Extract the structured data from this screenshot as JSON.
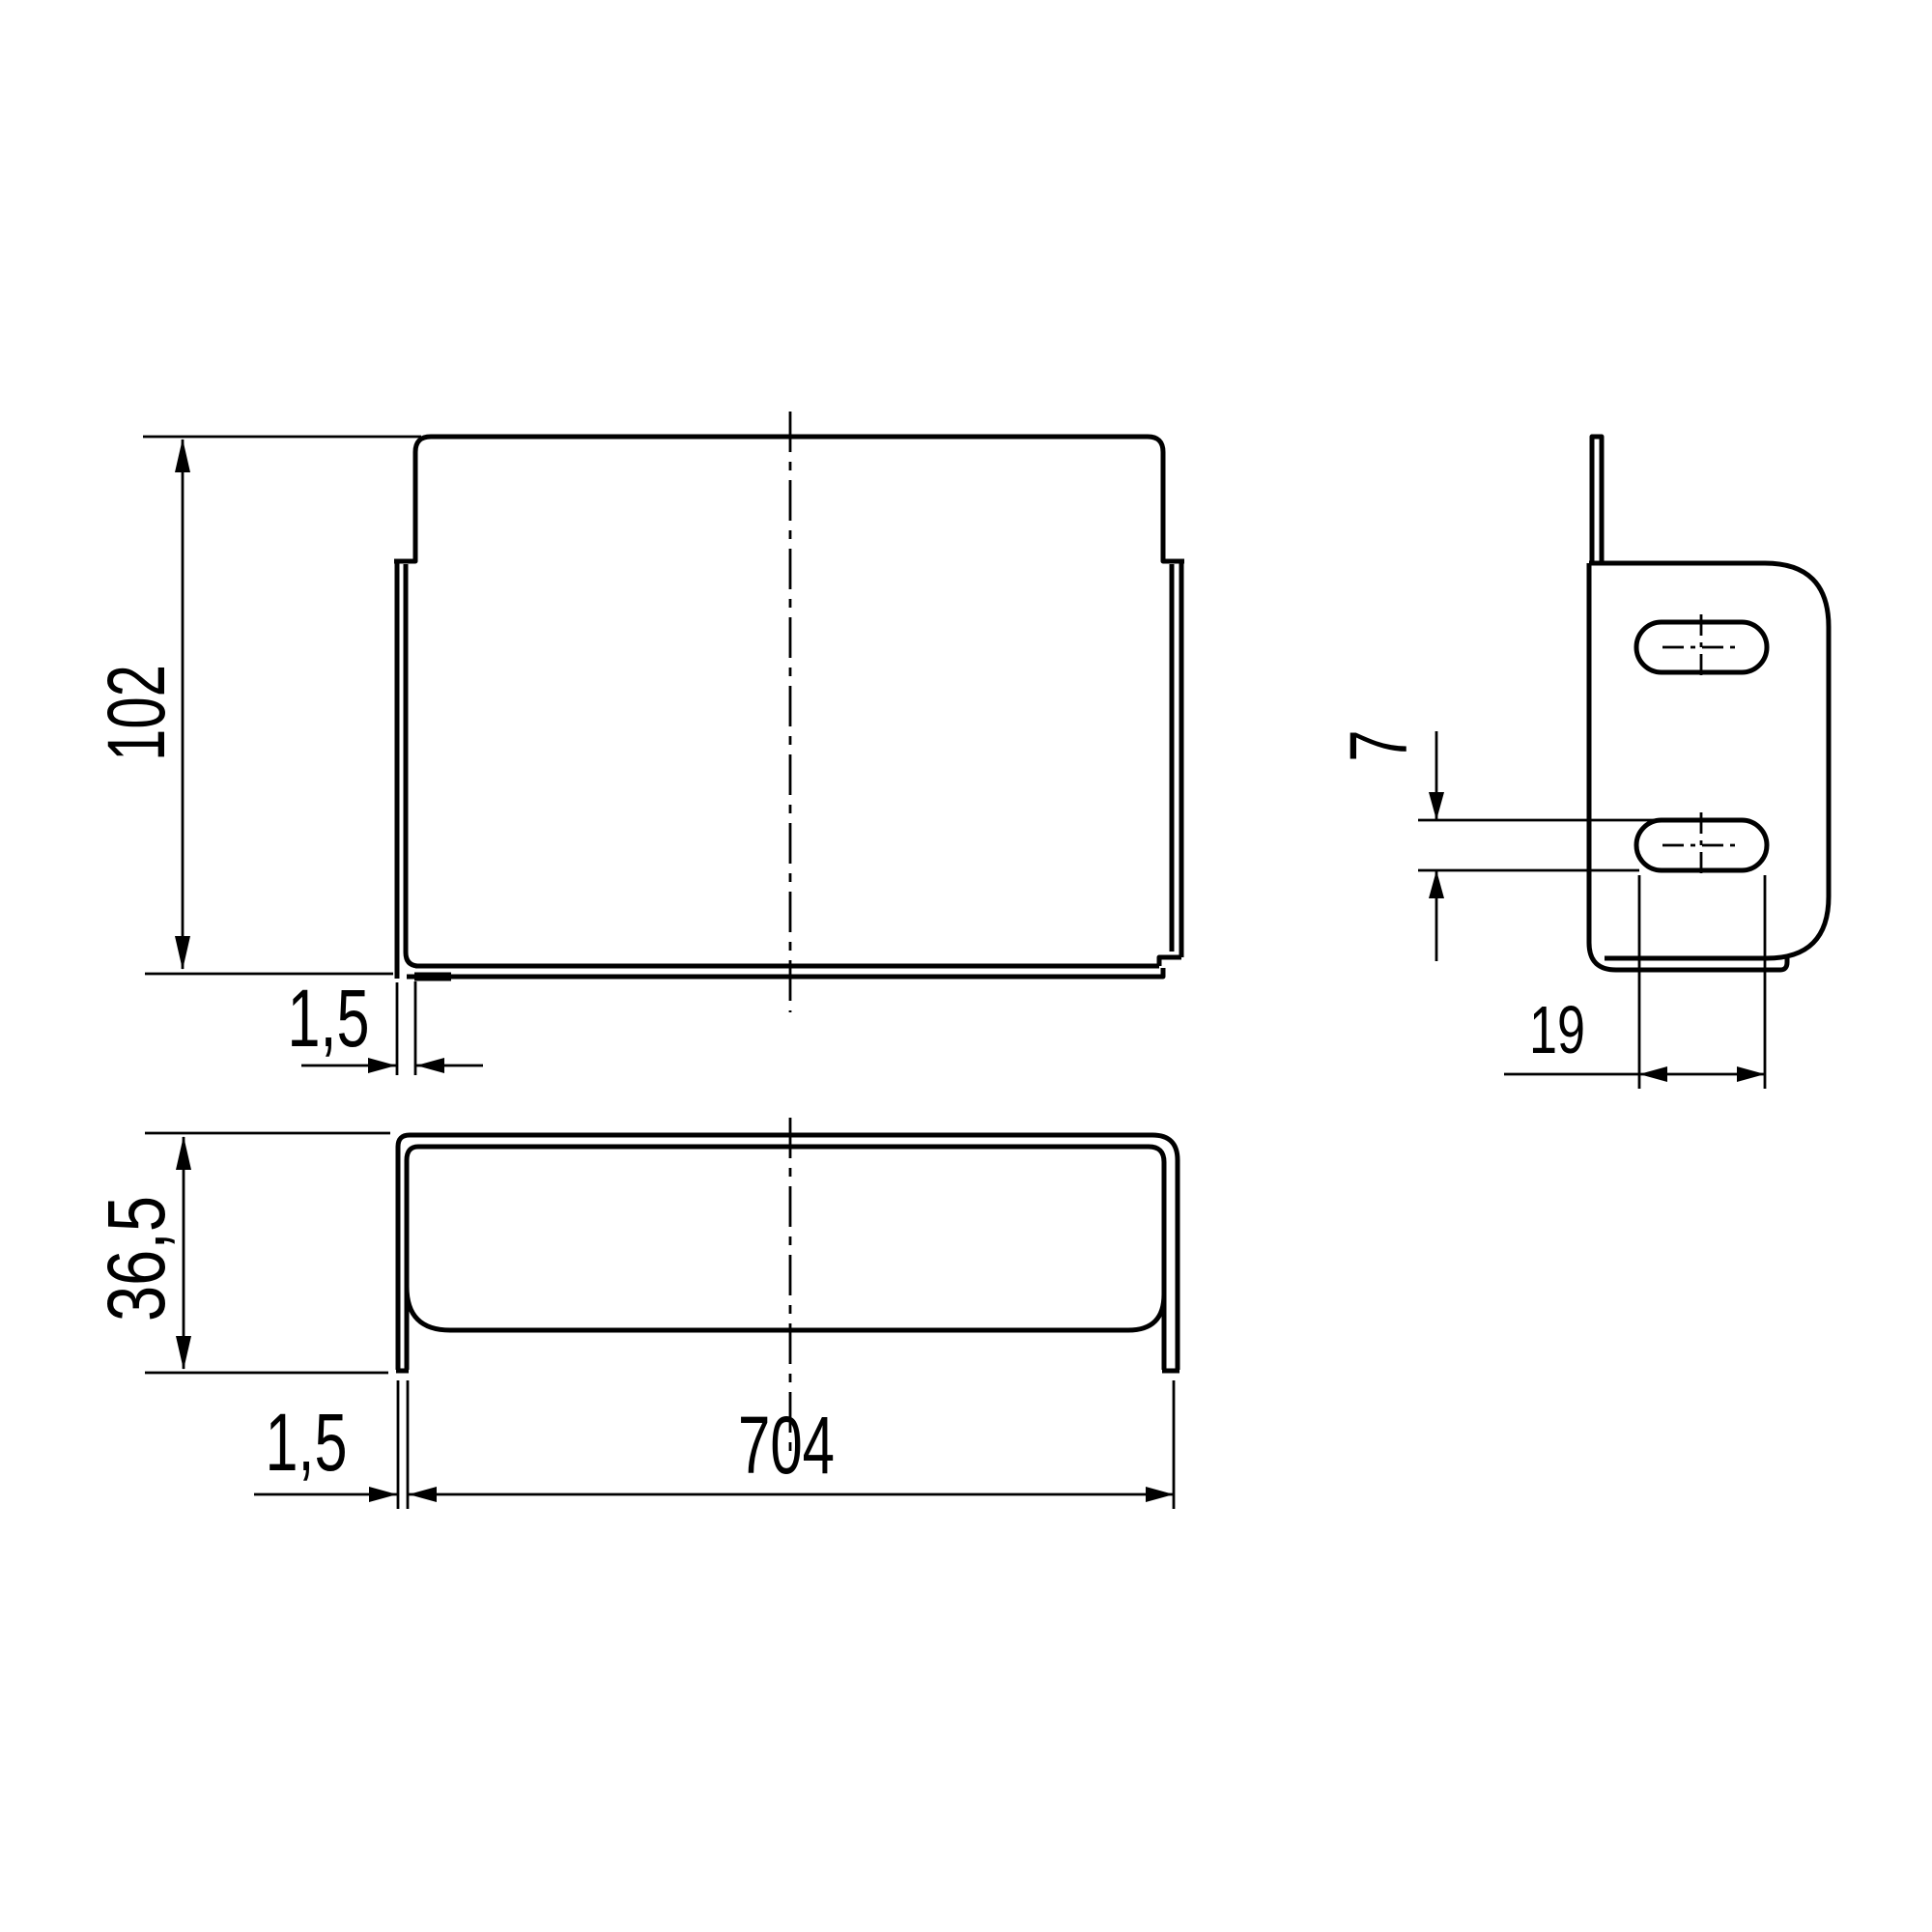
{
  "drawing": {
    "kind": "technical-dimension-drawing",
    "part": "sheet-metal cover bracket",
    "views": [
      "front-view",
      "plan-view",
      "side-view"
    ],
    "colors": {
      "line": "#000000",
      "background": "#ffffff"
    }
  },
  "dims": {
    "front_height": "102",
    "front_lip_thickness": "1,5",
    "plan_depth": "36,5",
    "plan_wall_thickness": "1,5",
    "plan_width": "704",
    "slot_height": "7",
    "slot_length": "19"
  }
}
